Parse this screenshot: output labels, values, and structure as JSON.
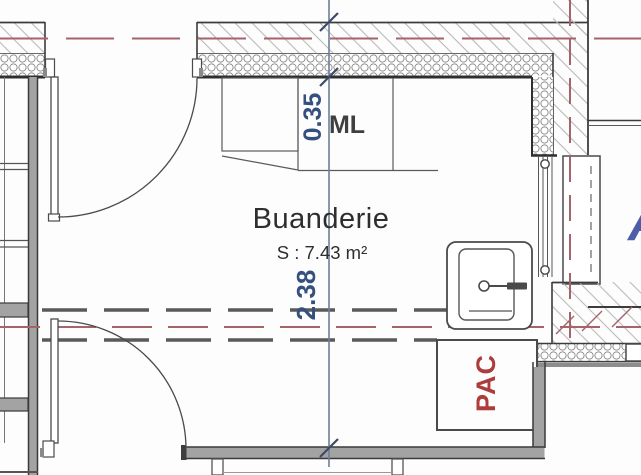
{
  "title": "Buanderie floor plan",
  "room": {
    "name": "Buanderie",
    "surface": "S : 7.43 m²"
  },
  "labels": {
    "washing_machine": "ML",
    "heat_pump": "PAC",
    "adjacent_letter": "A"
  },
  "dimensions": {
    "wall_thickness_m": "0.35",
    "room_width_m": "2.38"
  },
  "colors": {
    "ink": "#3c3c3c",
    "wall_fill": "#a3a3a3",
    "label_ink": "#2e2e2e",
    "ml_ink": "#3f3f3f",
    "dim_text_blue": "#35507e",
    "dim_line_blue": "#6e7f9a",
    "tick_blue": "#3d4a68",
    "axis_red": "#a5646a",
    "pac_red": "#ad3d3d",
    "letter_blue": "#4d5da8",
    "dash_gray": "#5a5a5a"
  }
}
